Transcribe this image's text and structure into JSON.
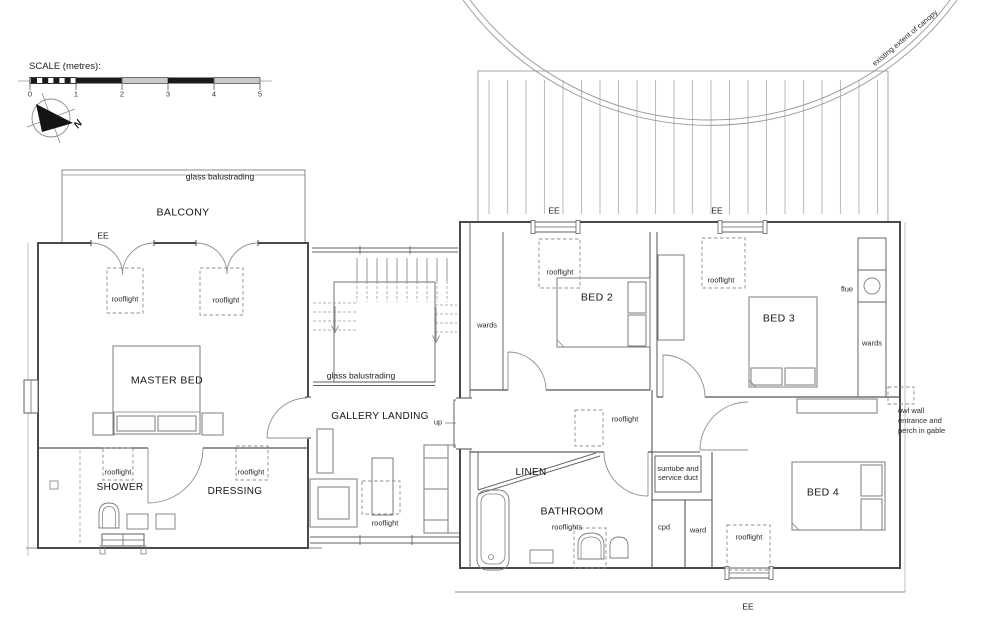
{
  "scale": {
    "label": "SCALE (metres):",
    "ticks": [
      "0",
      "1",
      "2",
      "3",
      "4",
      "5"
    ]
  },
  "compass": {
    "north": "N"
  },
  "canopy": {
    "extent_label": "existing extent of canopy"
  },
  "rooms": {
    "balcony": "BALCONY",
    "master_bed": "MASTER BED",
    "shower": "SHOWER",
    "dressing": "DRESSING",
    "gallery_landing": "GALLERY LANDING",
    "linen": "LINEN",
    "bathroom": "BATHROOM",
    "bed2": "BED 2",
    "bed3": "BED 3",
    "bed4": "BED 4"
  },
  "annotations": {
    "glass_balustrading": "glass balustrading",
    "rooflight": "rooflight",
    "rooflights": "rooflights",
    "ee": "EE",
    "wards": "wards",
    "ward": "ward",
    "flue": "flue",
    "cpd": "cpd",
    "up": "up",
    "suntube": "suntube and\nservice duct",
    "owl": "owl wall\nentrance and\nperch in gable"
  }
}
